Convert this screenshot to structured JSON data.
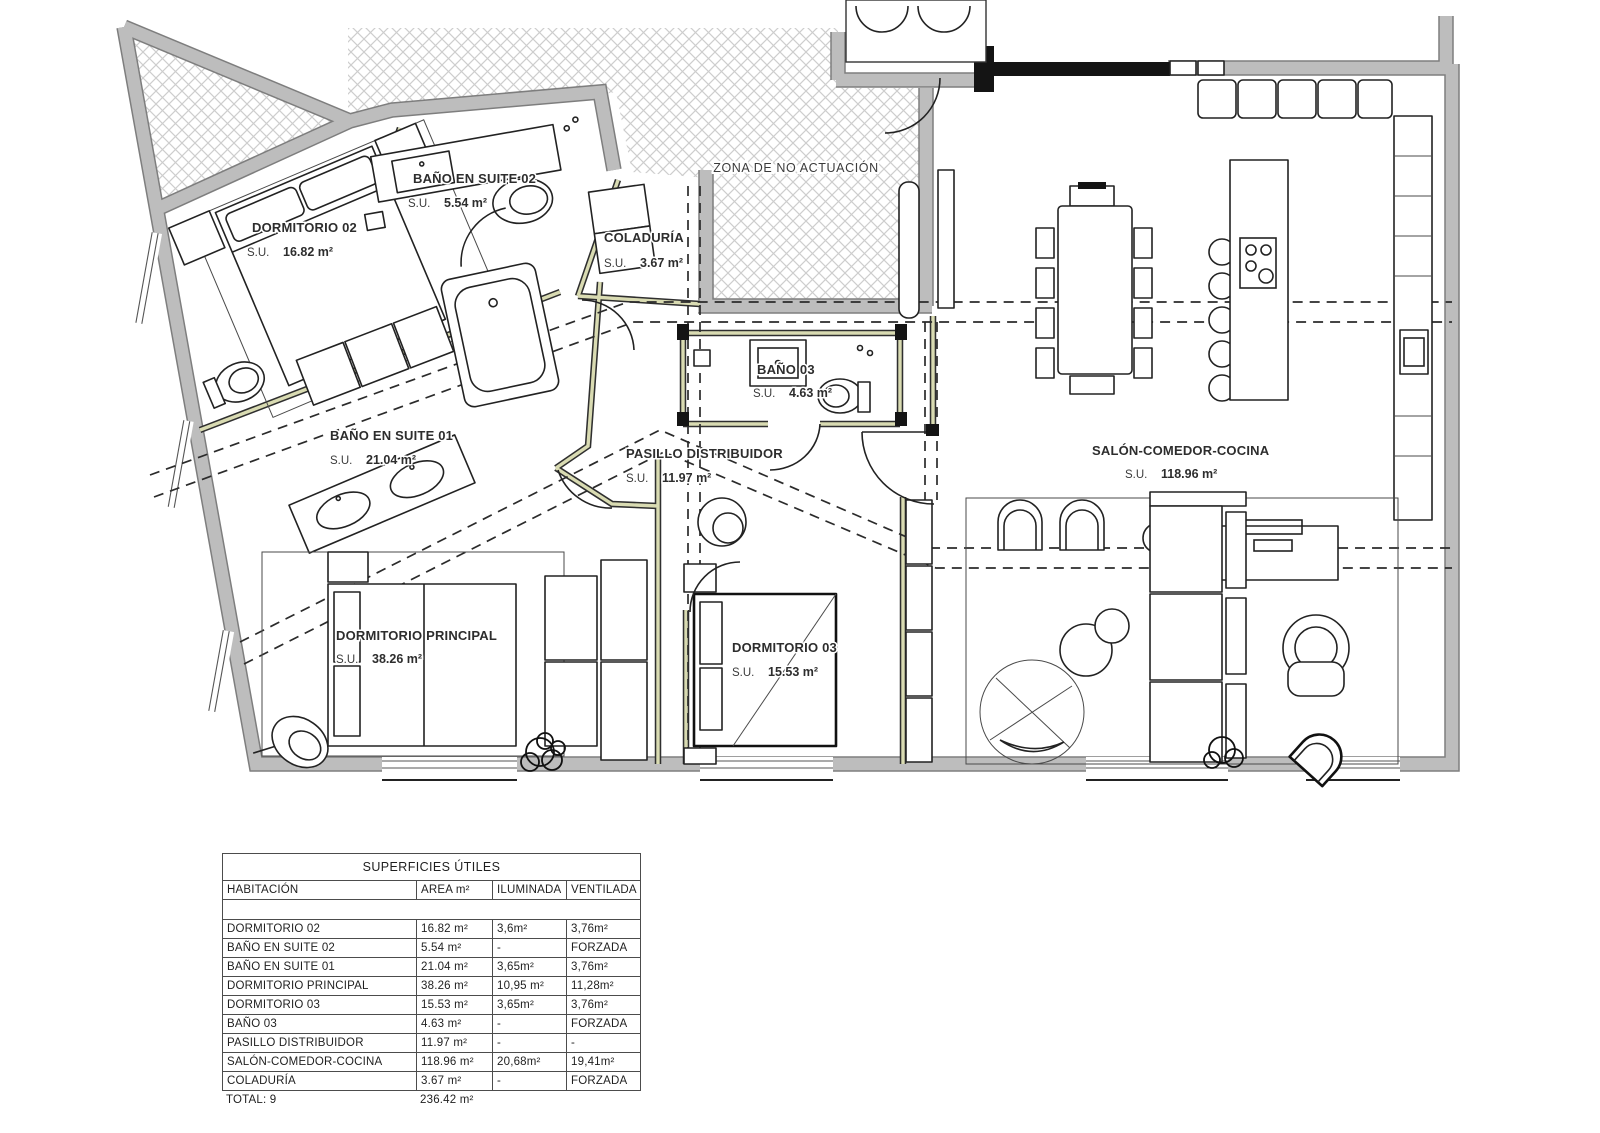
{
  "plan": {
    "zona_label": "ZONA DE NO ACTUACIÓN",
    "su_prefix": "S.U.",
    "rooms": {
      "dormitorio_02": {
        "name": "DORMITORIO 02",
        "area": "16.82 m²"
      },
      "bano_suite_02": {
        "name": "BAÑO EN SUITE 02",
        "area": "5.54 m²"
      },
      "coladuria": {
        "name": "COLADURÍA",
        "area": "3.67 m²"
      },
      "bano_suite_01": {
        "name": "BAÑO EN SUITE 01",
        "area": "21.04 m²"
      },
      "pasillo": {
        "name": "PASILLO DISTRIBUIDOR",
        "area": "11.97 m²"
      },
      "bano_03": {
        "name": "BAÑO 03",
        "area": "4.63 m²"
      },
      "salon": {
        "name": "SALÓN-COMEDOR-COCINA",
        "area": "118.96 m²"
      },
      "dormitorio_principal": {
        "name": "DORMITORIO PRINCIPAL",
        "area": "38.26 m²"
      },
      "dormitorio_03": {
        "name": "DORMITORIO 03",
        "area": "15.53 m²"
      }
    }
  },
  "surfaces_table": {
    "title": "SUPERFICIES ÚTILES",
    "headers": {
      "habitacion": "HABITACIÓN",
      "area": "AREA m²",
      "iluminada": "ILUMINADA",
      "ventilada": "VENTILADA"
    },
    "rows": [
      {
        "habitacion": "DORMITORIO 02",
        "area": "16.82 m²",
        "iluminada": "3,6m²",
        "ventilada": "3,76m²"
      },
      {
        "habitacion": "BAÑO EN SUITE 02",
        "area": "5.54 m²",
        "iluminada": "-",
        "ventilada": "FORZADA"
      },
      {
        "habitacion": "BAÑO EN SUITE 01",
        "area": "21.04 m²",
        "iluminada": "3,65m²",
        "ventilada": "3,76m²"
      },
      {
        "habitacion": "DORMITORIO PRINCIPAL",
        "area": "38.26 m²",
        "iluminada": "10,95 m²",
        "ventilada": "11,28m²"
      },
      {
        "habitacion": "DORMITORIO 03",
        "area": "15.53 m²",
        "iluminada": "3,65m²",
        "ventilada": "3,76m²"
      },
      {
        "habitacion": "BAÑO 03",
        "area": "4.63 m²",
        "iluminada": "-",
        "ventilada": "FORZADA"
      },
      {
        "habitacion": "PASILLO DISTRIBUIDOR",
        "area": "11.97 m²",
        "iluminada": "-",
        "ventilada": "-"
      },
      {
        "habitacion": "SALÓN-COMEDOR-COCINA",
        "area": "118.96 m²",
        "iluminada": "20,68m²",
        "ventilada": "19,41m²"
      },
      {
        "habitacion": "COLADURÍA",
        "area": "3.67 m²",
        "iluminada": "-",
        "ventilada": "FORZADA"
      }
    ],
    "total": {
      "label": "TOTAL: 9",
      "area": "236.42 m²"
    }
  }
}
